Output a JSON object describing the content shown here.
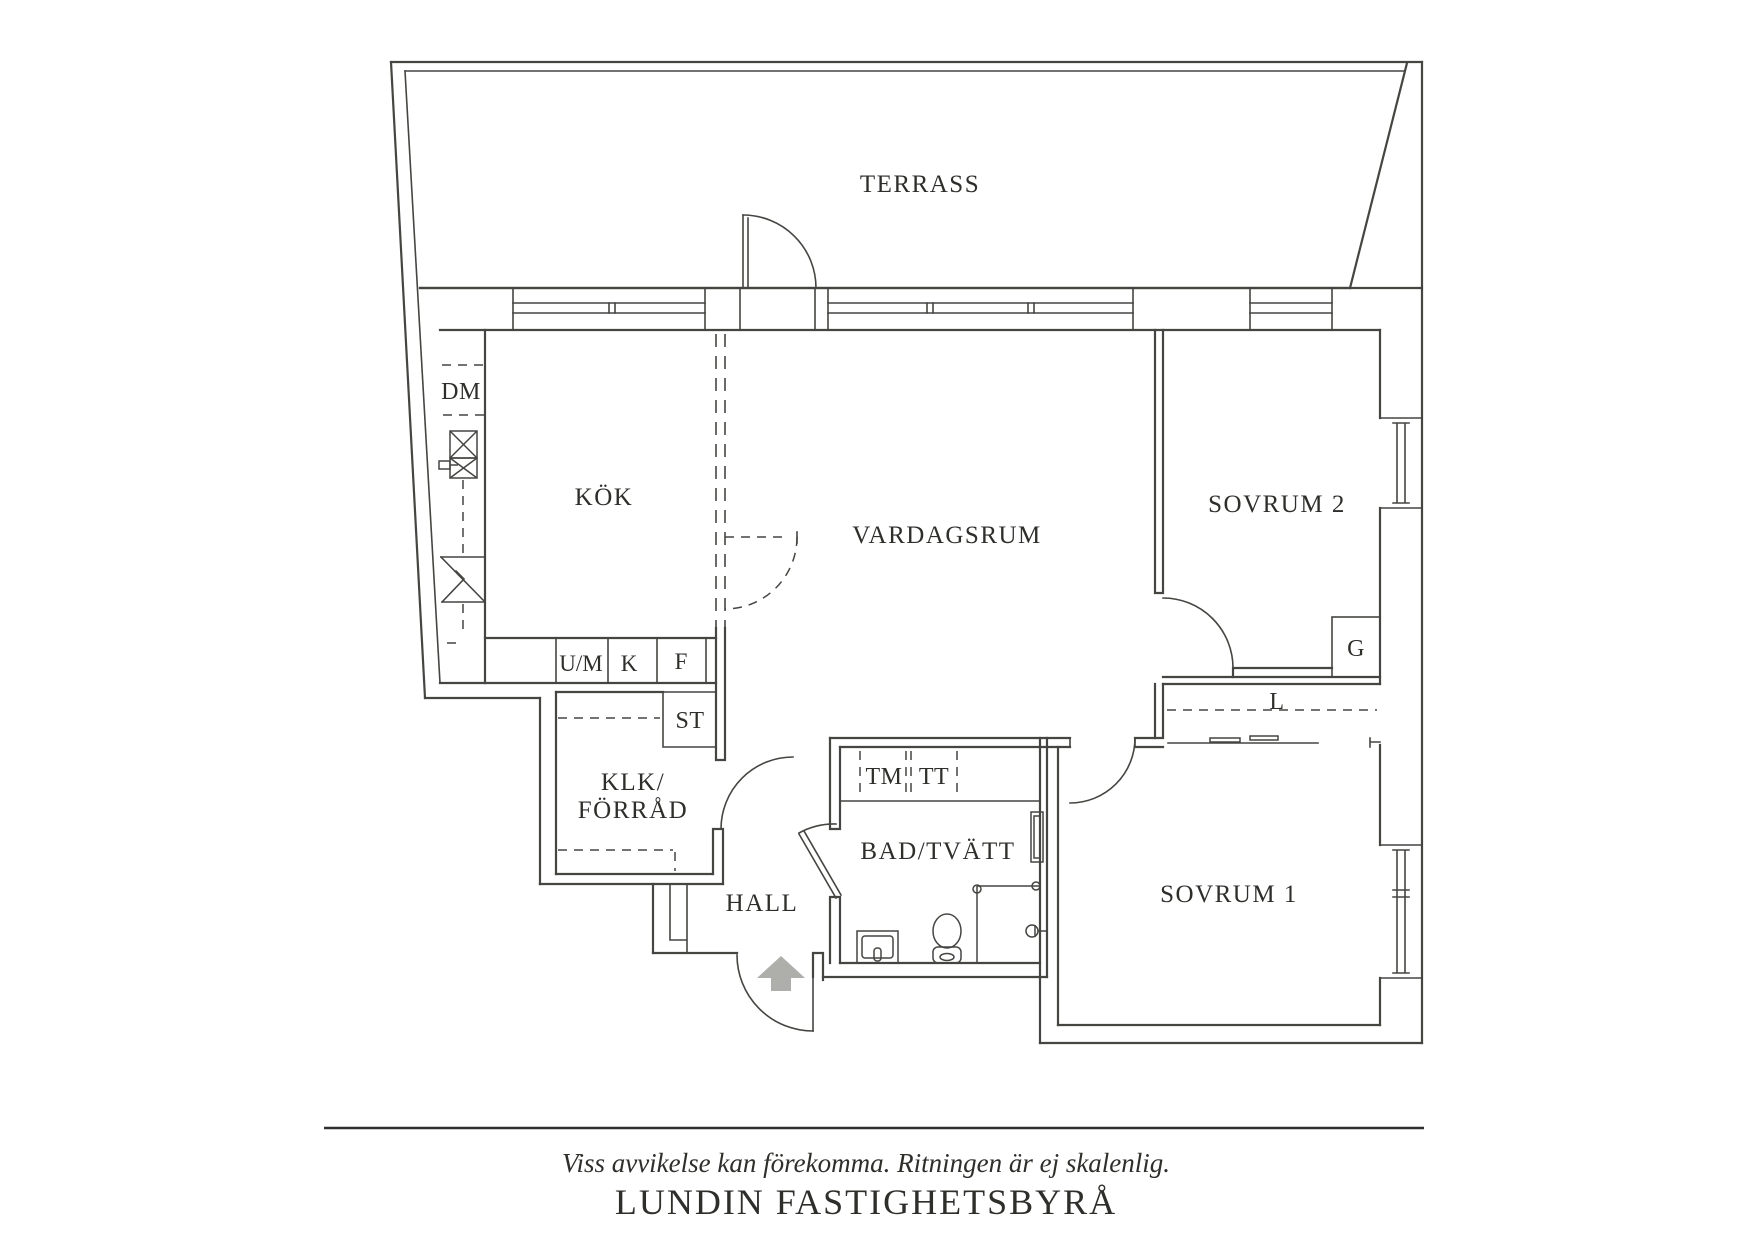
{
  "rooms": {
    "terrace": "TERRASS",
    "kitchen": "KÖK",
    "living_room": "VARDAGSRUM",
    "bedroom2": "SOVRUM 2",
    "bedroom1": "SOVRUM 1",
    "bathroom": "BAD/TVÄTT",
    "hall": "HALL",
    "closet_room_line1": "KLK/",
    "closet_room_line2": "FÖRRÅD"
  },
  "fixtures": {
    "dishwasher": "DM",
    "washer_um": "U/M",
    "cabinet_k": "K",
    "freezer_f": "F",
    "cleaning_st": "ST",
    "washing_machine_tm": "TM",
    "dryer_tt": "TT",
    "wardrobe_g": "G",
    "wardrobe_l": "L"
  },
  "footer": {
    "disclaimer": "Viss avvikelse kan förekomma. Ritningen är ej skalenlig.",
    "agency": "LUNDIN FASTIGHETSBYRÅ"
  },
  "colors": {
    "line": "#454542",
    "text": "#2e2e2b",
    "entry_arrow": "#aeaeab",
    "background": "#ffffff"
  }
}
